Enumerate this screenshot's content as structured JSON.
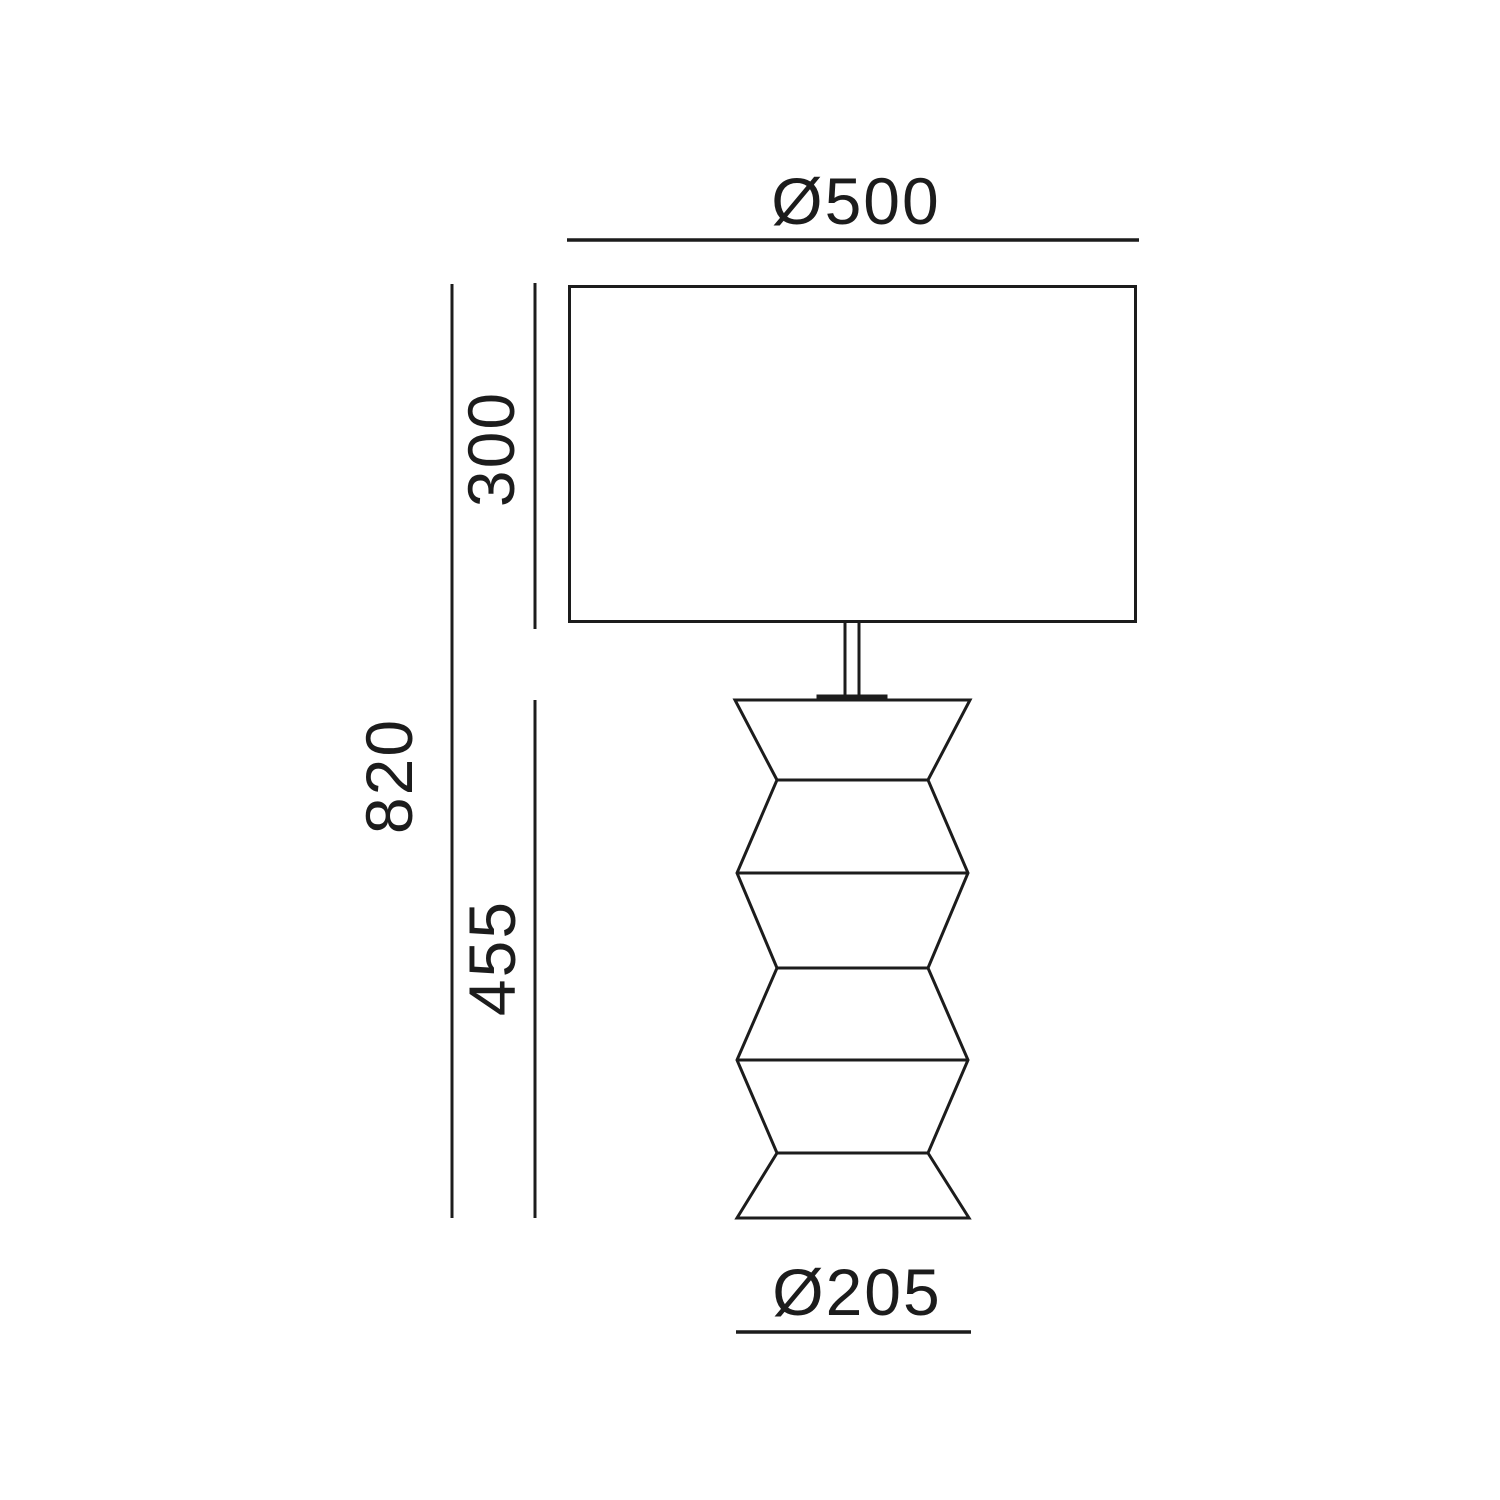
{
  "drawing": {
    "labels": {
      "shade_diameter": "Ø500",
      "shade_height": "300",
      "overall_height": "820",
      "base_height": "455",
      "base_diameter": "Ø205"
    },
    "colors": {
      "line": "#1c1c1c",
      "background": "#ffffff"
    }
  }
}
